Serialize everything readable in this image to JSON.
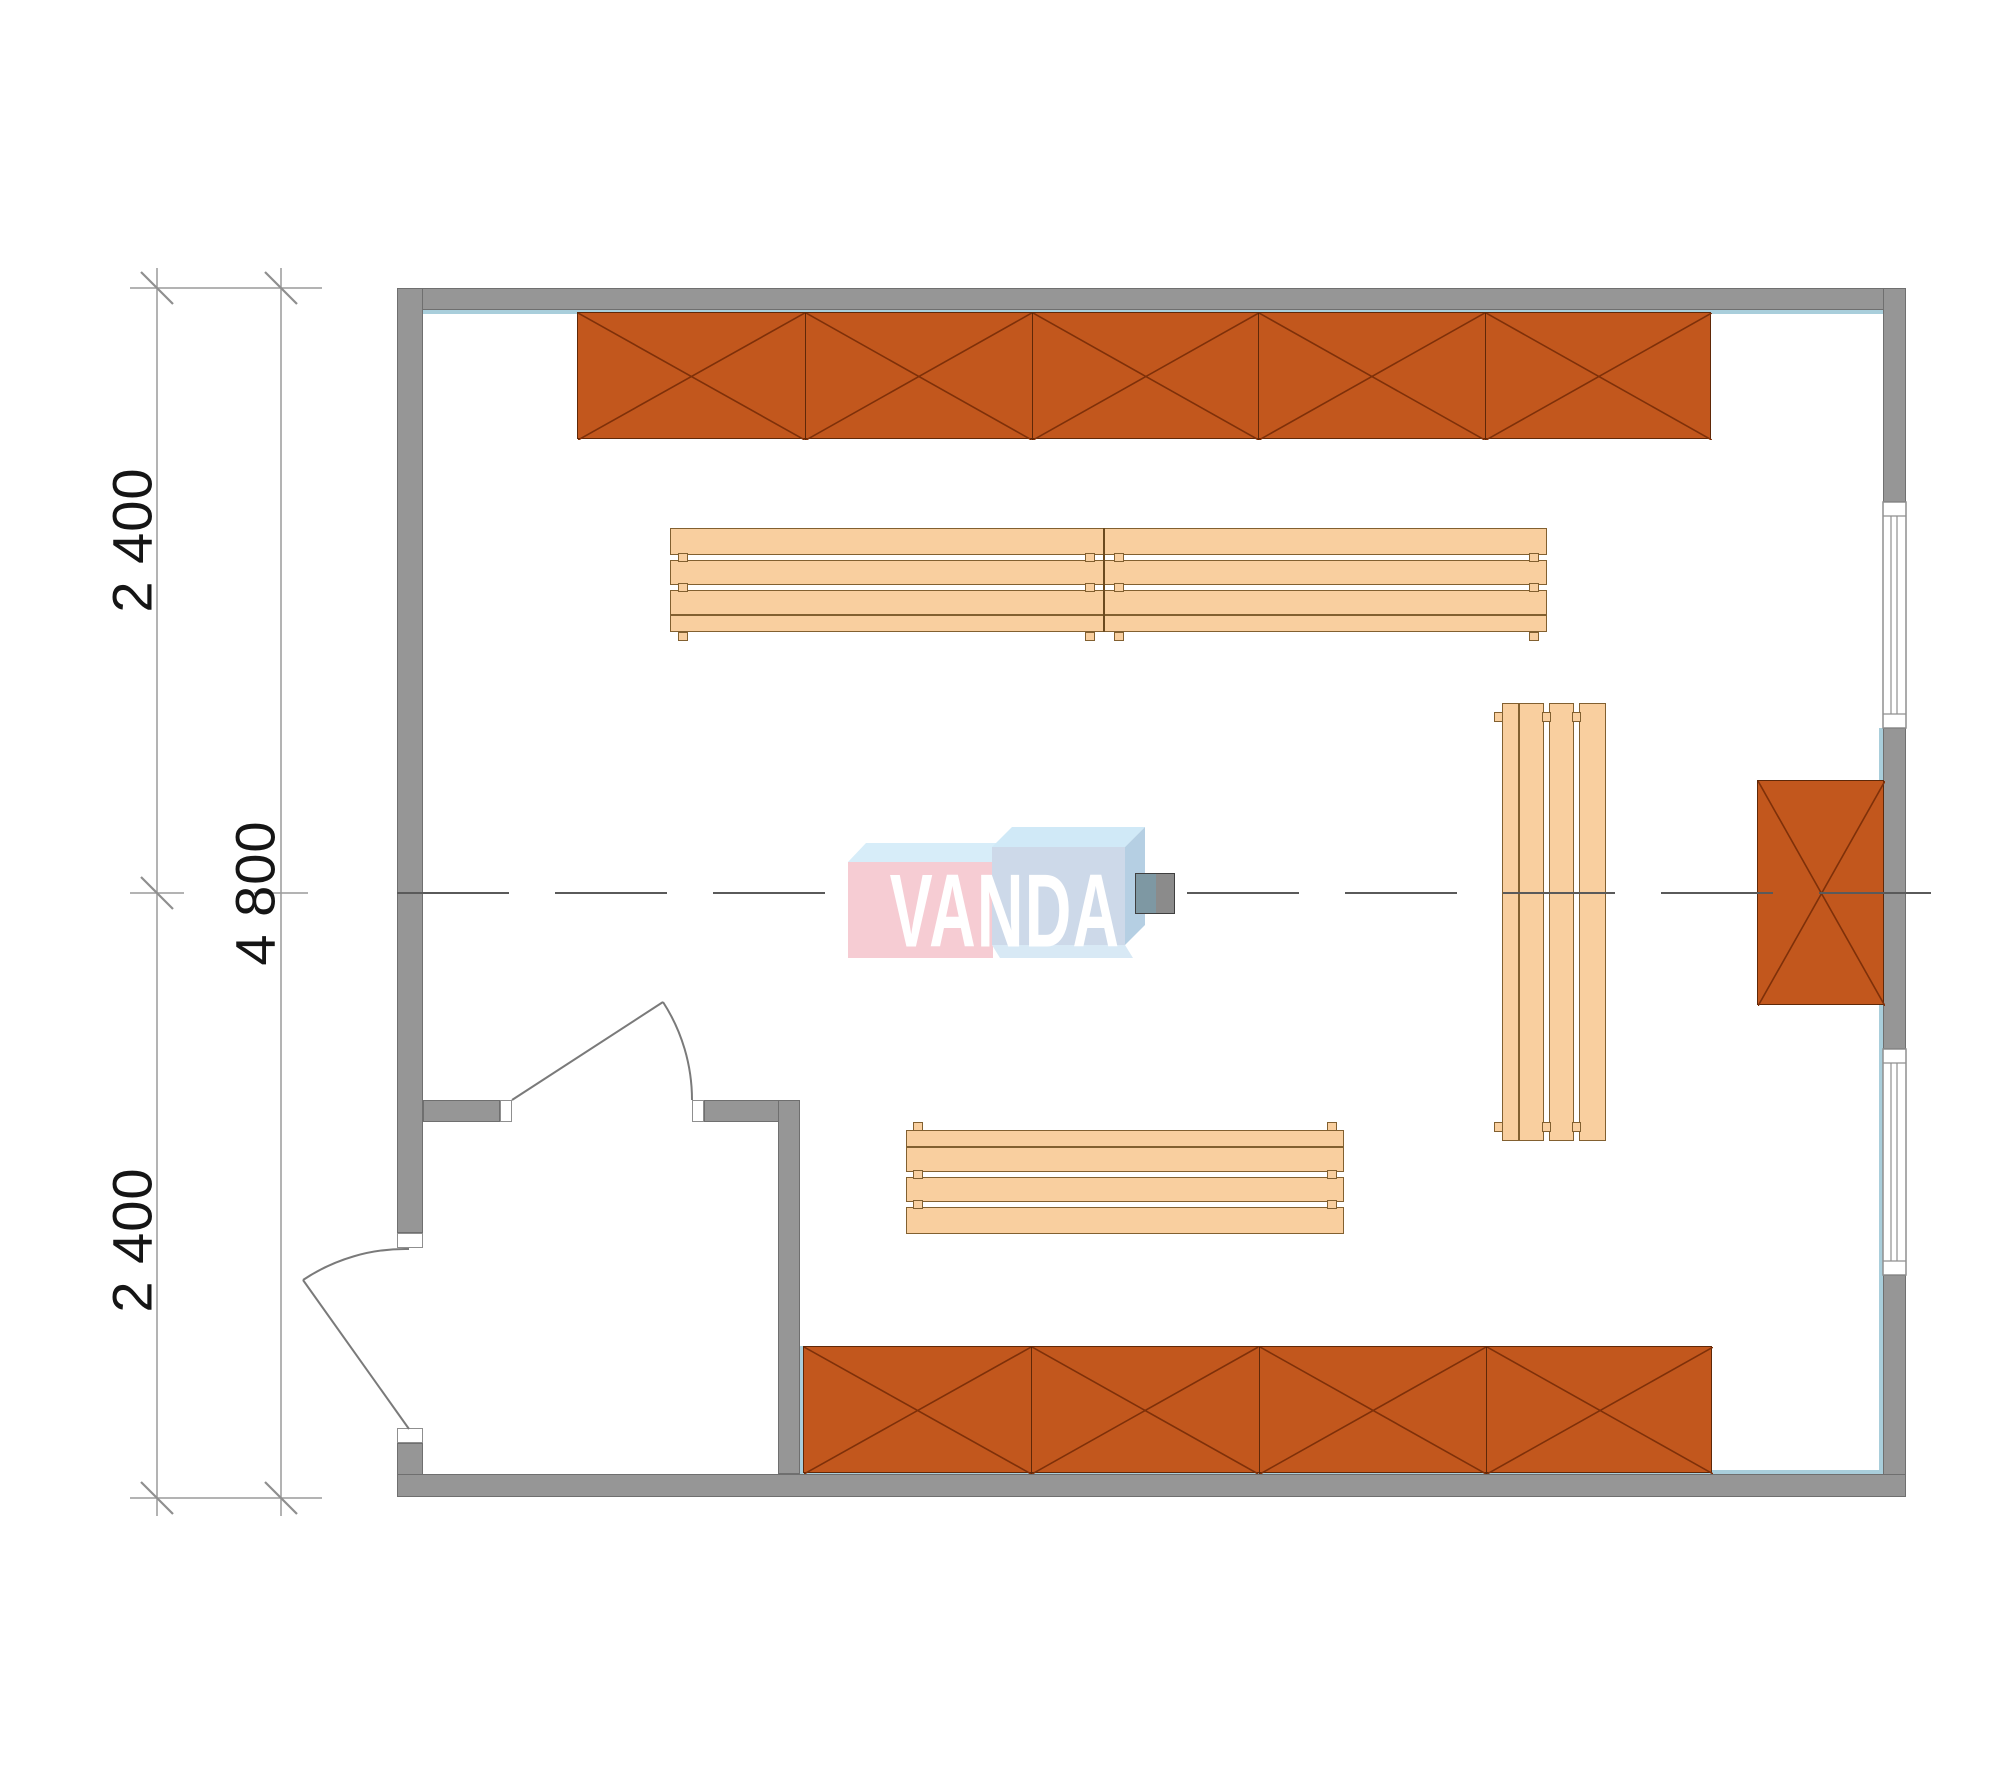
{
  "title": "floor-plan",
  "dimensions": {
    "left_top": "2 400",
    "left_bottom": "2 400",
    "overall": "4 800"
  },
  "watermark": {
    "text": "VANDA"
  },
  "colors": {
    "wall": "#969696",
    "wall_outline": "#6f6f6f",
    "cabinet_fill": "#c2571d",
    "cabinet_line": "#7e3009",
    "bench_fill": "#f9cf9f",
    "bench_outline": "#826030",
    "wall_lining": "#a9cedb",
    "centerline": "#5a5a5a",
    "dimension_line": "#9a9a9a",
    "dimension_text": "#151515",
    "logo_pink": "#f6ccd3",
    "logo_blue": "#cdd9e9",
    "logo_top_face": "#d7edf9",
    "logo_side_face": "#b5cfe3",
    "equipment_left": "#7e98a3",
    "equipment_right": "#8b8b8b"
  },
  "plan": {
    "canvas": {
      "w": 2000,
      "h": 1786
    },
    "walls": [
      {
        "x": 397,
        "y": 288,
        "w": 1509,
        "h": 22
      },
      {
        "x": 397,
        "y": 288,
        "w": 26,
        "h": 945
      },
      {
        "x": 397,
        "y": 1443,
        "w": 26,
        "h": 54
      },
      {
        "x": 1883,
        "y": 288,
        "w": 23,
        "h": 214
      },
      {
        "x": 1883,
        "y": 728,
        "w": 23,
        "h": 321
      },
      {
        "x": 1883,
        "y": 1275,
        "w": 23,
        "h": 222
      },
      {
        "x": 397,
        "y": 1474,
        "w": 1509,
        "h": 23
      },
      {
        "x": 423,
        "y": 1100,
        "w": 77,
        "h": 22
      },
      {
        "x": 704,
        "y": 1100,
        "w": 96,
        "h": 22
      },
      {
        "x": 778,
        "y": 1100,
        "w": 22,
        "h": 374
      }
    ],
    "jambs": [
      {
        "x": 500,
        "y": 1100,
        "w": 12,
        "h": 22
      },
      {
        "x": 692,
        "y": 1100,
        "w": 12,
        "h": 22
      },
      {
        "x": 397,
        "y": 1233,
        "w": 26,
        "h": 15
      },
      {
        "x": 397,
        "y": 1428,
        "w": 26,
        "h": 15
      }
    ],
    "linings": [
      {
        "x": 423,
        "y": 310,
        "w": 1460,
        "h": 4
      },
      {
        "x": 1879,
        "y": 728,
        "w": 4,
        "h": 746
      },
      {
        "x": 800,
        "y": 1346,
        "w": 4,
        "h": 128
      },
      {
        "x": 803,
        "y": 1470,
        "w": 1080,
        "h": 4
      }
    ],
    "cabinet_runs": [
      {
        "name": "top-cabinet-run",
        "x": 577,
        "y": 312,
        "w": 1134,
        "h": 127,
        "units": 5
      },
      {
        "name": "bottom-cabinet-run",
        "x": 803,
        "y": 1346,
        "w": 909,
        "h": 127,
        "units": 4
      },
      {
        "name": "right-wall-cabinet",
        "x": 1757,
        "y": 780,
        "w": 127,
        "h": 225,
        "units": 1
      }
    ],
    "benches": [
      {
        "name": "top-bench",
        "x": 670,
        "y": 528,
        "len": 877,
        "dir": "h",
        "flip": false,
        "joints": [
          433
        ],
        "tabs": [
          8,
          415,
          444,
          859
        ]
      },
      {
        "name": "bottom-bench",
        "x": 906,
        "y": 1130,
        "len": 438,
        "dir": "h",
        "flip": true,
        "joints": [],
        "tabs": [
          7,
          421
        ]
      },
      {
        "name": "vertical-bench",
        "x": 1502,
        "y": 703,
        "len": 438,
        "dir": "v",
        "flip": true,
        "joints": [],
        "tabs": [
          9,
          419
        ]
      }
    ],
    "equipment": {
      "x": 1135,
      "y": 873,
      "w": 38,
      "h": 39
    }
  }
}
